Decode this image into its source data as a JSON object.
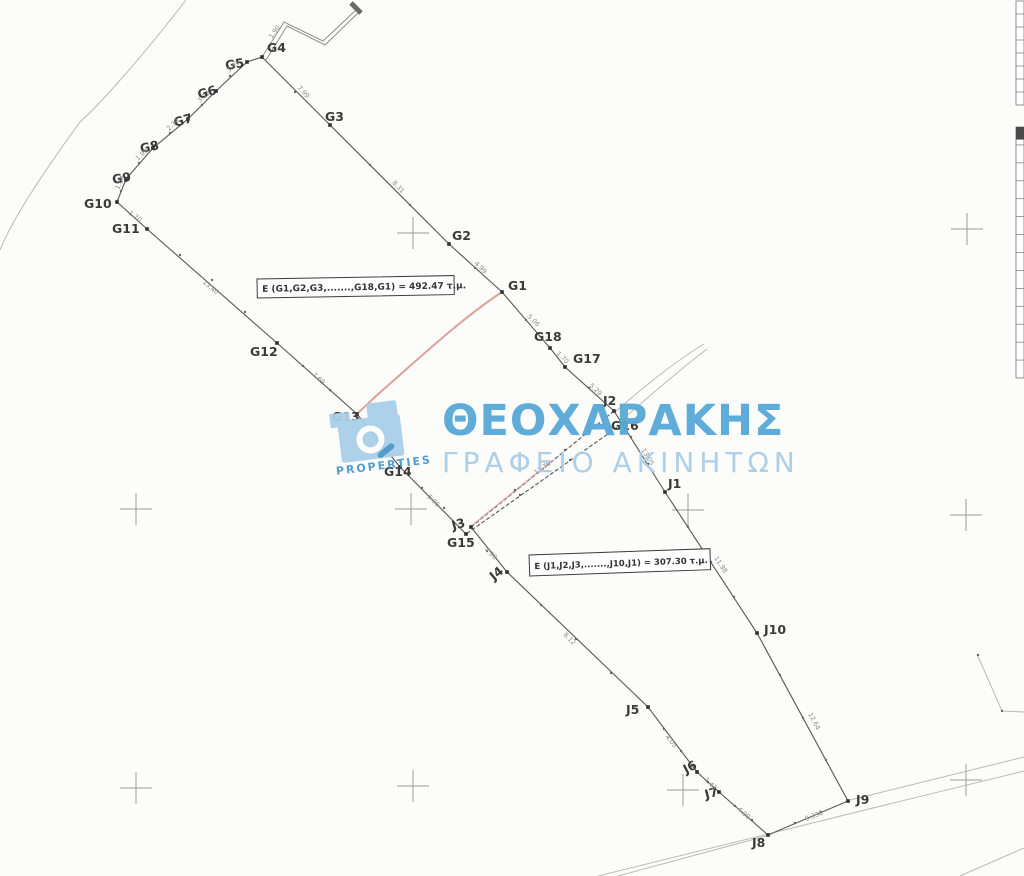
{
  "canvas": {
    "w": 1024,
    "h": 876
  },
  "watermark": {
    "brand": "ΘΕΟΧΑΡΑΚΗΣ",
    "subtitle": "ΓΡΑΦΕΙΟ ΑΚΙΝΗΤΩΝ",
    "logo_text": "PROPERTIES",
    "color_primary": "#58a8d8",
    "color_light": "#a9cde6"
  },
  "colors": {
    "boundary": "#5c5c5c",
    "road": "#b9b9b5",
    "cross": "#9c9c9c",
    "dim": "#8a8a8a",
    "label": "#3a3a3a",
    "red": "#d2837c",
    "red_light": "#dfa09a",
    "box_border": "#3c3c3c",
    "table": "#777777",
    "marker": "#2f2f2f",
    "dot": "#666666"
  },
  "area_labels": [
    {
      "id": "g-parcel",
      "text": "E (G1,G2,G3,.......,G18,G1) = 492.47 τ.μ.",
      "x": 257,
      "y": 279,
      "w": 197,
      "h": 19,
      "rot": -1,
      "font": 9
    },
    {
      "id": "j-parcel",
      "text": "E (J1,J2,J3,.......,J10,J1) = 307.30 τ.μ.",
      "x": 529,
      "y": 555,
      "w": 181,
      "h": 21,
      "rot": -2,
      "font": 8.5
    }
  ],
  "points": [
    {
      "name": "G1",
      "x": 502,
      "y": 292,
      "lx": 508,
      "ly": 290,
      "rot": 0
    },
    {
      "name": "G2",
      "x": 449,
      "y": 244,
      "lx": 452,
      "ly": 240,
      "rot": 0
    },
    {
      "name": "G3",
      "x": 330,
      "y": 125,
      "lx": 325,
      "ly": 121,
      "rot": 0
    },
    {
      "name": "G4",
      "x": 262,
      "y": 57,
      "lx": 267,
      "ly": 52,
      "rot": 0
    },
    {
      "name": "G5",
      "x": 247,
      "y": 62,
      "lx": 226,
      "ly": 70,
      "rot": -10
    },
    {
      "name": "G6",
      "x": 216,
      "y": 91,
      "lx": 199,
      "ly": 99,
      "rot": -16
    },
    {
      "name": "G7",
      "x": 188,
      "y": 119,
      "lx": 175,
      "ly": 127,
      "rot": -16
    },
    {
      "name": "G8",
      "x": 153,
      "y": 148,
      "lx": 141,
      "ly": 153,
      "rot": -12
    },
    {
      "name": "G9",
      "x": 126,
      "y": 179,
      "lx": 113,
      "ly": 184,
      "rot": -10
    },
    {
      "name": "G10",
      "x": 117,
      "y": 202,
      "lx": 84,
      "ly": 208,
      "rot": 0
    },
    {
      "name": "G11",
      "x": 147,
      "y": 229,
      "lx": 112,
      "ly": 233,
      "rot": 0
    },
    {
      "name": "G12",
      "x": 277,
      "y": 343,
      "lx": 250,
      "ly": 356,
      "rot": 0
    },
    {
      "name": "G13",
      "x": 357,
      "y": 414,
      "lx": 332,
      "ly": 421,
      "rot": 0
    },
    {
      "name": "G14",
      "x": 400,
      "y": 467,
      "lx": 384,
      "ly": 476,
      "rot": 0
    },
    {
      "name": "G15",
      "x": 466,
      "y": 534,
      "lx": 447,
      "ly": 547,
      "rot": 0
    },
    {
      "name": "G16",
      "x": 622,
      "y": 424,
      "lx": 611,
      "ly": 430,
      "rot": 0
    },
    {
      "name": "G17",
      "x": 565,
      "y": 367,
      "lx": 573,
      "ly": 363,
      "rot": 0
    },
    {
      "name": "G18",
      "x": 550,
      "y": 348,
      "lx": 534,
      "ly": 341,
      "rot": 0
    },
    {
      "name": "J1",
      "x": 665,
      "y": 492,
      "lx": 668,
      "ly": 488,
      "rot": 0
    },
    {
      "name": "J2",
      "x": 614,
      "y": 411,
      "lx": 603,
      "ly": 405,
      "rot": 0
    },
    {
      "name": "J3",
      "x": 471,
      "y": 527,
      "lx": 453,
      "ly": 530,
      "rot": -15
    },
    {
      "name": "J4",
      "x": 507,
      "y": 572,
      "lx": 494,
      "ly": 581,
      "rot": -40
    },
    {
      "name": "J5",
      "x": 648,
      "y": 707,
      "lx": 626,
      "ly": 714,
      "rot": 0
    },
    {
      "name": "J6",
      "x": 697,
      "y": 772,
      "lx": 686,
      "ly": 774,
      "rot": -28
    },
    {
      "name": "J7",
      "x": 719,
      "y": 792,
      "lx": 706,
      "ly": 799,
      "rot": -15
    },
    {
      "name": "J8",
      "x": 768,
      "y": 835,
      "lx": 752,
      "ly": 847,
      "rot": 0
    },
    {
      "name": "J9",
      "x": 848,
      "y": 801,
      "lx": 856,
      "ly": 804,
      "rot": 0
    },
    {
      "name": "J10",
      "x": 757,
      "y": 633,
      "lx": 764,
      "ly": 634,
      "rot": 0
    }
  ],
  "outlines": [
    {
      "id": "g-north-boundary",
      "pts": [
        "G4",
        "G3",
        "G2",
        "G1"
      ],
      "dash": ""
    },
    {
      "id": "g-west-boundary",
      "pts": [
        "G4",
        "G5",
        "G6",
        "G7",
        "G8",
        "G9",
        "G10",
        "G11"
      ],
      "dash": ""
    },
    {
      "id": "g-southwest-boundary",
      "pts": [
        "G11",
        "G12",
        "G13",
        "G14",
        "G15"
      ],
      "dash": ""
    },
    {
      "id": "ne-road-boundary",
      "pts": [
        "G1",
        "G18",
        "G17",
        "J2",
        "J1",
        "J10",
        "J9"
      ],
      "dash": ""
    },
    {
      "id": "divider-g15-g16",
      "pts": [
        "G16",
        "G15"
      ],
      "dash": "4 2"
    },
    {
      "id": "divider-j2-j3",
      "pts": [
        "J2",
        "J3"
      ],
      "dash": "4 2"
    },
    {
      "id": "j-southwest-boundary",
      "pts": [
        "J3",
        "J4",
        "J5",
        "J6",
        "J7",
        "J8"
      ],
      "dash": ""
    },
    {
      "id": "j-south-boundary",
      "pts": [
        "J8",
        "J9"
      ],
      "dash": ""
    }
  ],
  "dots": [
    [
      295,
      92
    ],
    [
      370,
      165
    ],
    [
      410,
      205
    ],
    [
      475,
      268
    ],
    [
      526,
      320
    ],
    [
      589,
      388
    ],
    [
      230,
      76
    ],
    [
      202,
      105
    ],
    [
      170,
      133
    ],
    [
      139,
      163
    ],
    [
      121,
      191
    ],
    [
      180,
      255
    ],
    [
      212,
      280
    ],
    [
      245,
      312
    ],
    [
      303,
      366
    ],
    [
      330,
      390
    ],
    [
      378,
      440
    ],
    [
      422,
      488
    ],
    [
      444,
      508
    ],
    [
      487,
      551
    ],
    [
      541,
      605
    ],
    [
      576,
      639
    ],
    [
      611,
      673
    ],
    [
      664,
      729
    ],
    [
      681,
      751
    ],
    [
      708,
      782
    ],
    [
      735,
      806
    ],
    [
      752,
      820
    ],
    [
      795,
      823
    ],
    [
      821,
      812
    ],
    [
      631,
      437
    ],
    [
      648,
      464
    ],
    [
      688,
      527
    ],
    [
      711,
      562
    ],
    [
      734,
      597
    ],
    [
      780,
      675
    ],
    [
      803,
      718
    ],
    [
      826,
      760
    ],
    [
      570,
      460
    ],
    [
      520,
      495
    ],
    [
      565,
      450
    ],
    [
      515,
      490
    ],
    [
      978,
      655
    ],
    [
      1002,
      711
    ]
  ],
  "red_paths": [
    {
      "id": "red-curve-g1-g13",
      "d": "M502,292 C462,318 415,362 376,396 C369,403 363,408 358,413",
      "w": 2,
      "color": "red",
      "op": 0.75
    },
    {
      "id": "red-divider-segment",
      "d": "M470,527 L553,460",
      "w": 1.4,
      "color": "red_light",
      "op": 0.8
    }
  ],
  "roads": [
    "M186,0 C140,60 96,108 80,122 C45,170 12,220 0,250",
    "M615,412 C648,383 676,361 704,344",
    "M622,420 C654,392 682,368 707,349",
    "M618,876 L766,836",
    "M850,800 L1024,757",
    "M598,876 C720,846 880,806 1024,771",
    "M960,876 L1024,848",
    "M977,654 L1002,711 L1024,712"
  ],
  "zigzag": {
    "outer": "M262,57 L284,22 L323,41 L356,10",
    "inner": "M266,60 L287,26 L325,45 L358,13",
    "cap": {
      "x1": 351,
      "y1": 3,
      "x2": 361,
      "y2": 13
    }
  },
  "crosses": [
    [
      413,
      233
    ],
    [
      967,
      229
    ],
    [
      136,
      509
    ],
    [
      411,
      509
    ],
    [
      688,
      510
    ],
    [
      966,
      515
    ],
    [
      136,
      788
    ],
    [
      413,
      786
    ],
    [
      683,
      790
    ],
    [
      966,
      780
    ]
  ],
  "cross_size": 16,
  "dims": [
    {
      "x": 297,
      "y": 88,
      "rot": 47,
      "t": "7.99"
    },
    {
      "x": 392,
      "y": 183,
      "rot": 47,
      "t": "8.31"
    },
    {
      "x": 474,
      "y": 264,
      "rot": 44,
      "t": "4.99"
    },
    {
      "x": 527,
      "y": 317,
      "rot": 44,
      "t": "5.06"
    },
    {
      "x": 556,
      "y": 354,
      "rot": 44,
      "t": "1.70"
    },
    {
      "x": 589,
      "y": 386,
      "rot": 44,
      "t": "5.29"
    },
    {
      "x": 229,
      "y": 73,
      "rot": -43,
      "t": "3.43"
    },
    {
      "x": 200,
      "y": 103,
      "rot": -43,
      "t": "3.17"
    },
    {
      "x": 169,
      "y": 131,
      "rot": -43,
      "t": "2.39"
    },
    {
      "x": 138,
      "y": 161,
      "rot": -43,
      "t": "1.99"
    },
    {
      "x": 119,
      "y": 190,
      "rot": -65,
      "t": "1.04"
    },
    {
      "x": 128,
      "y": 214,
      "rot": 35,
      "t": "1.70"
    },
    {
      "x": 202,
      "y": 283,
      "rot": 39,
      "t": "13.40"
    },
    {
      "x": 312,
      "y": 375,
      "rot": 43,
      "t": "7.69"
    },
    {
      "x": 427,
      "y": 497,
      "rot": 46,
      "t": "5.96"
    },
    {
      "x": 484,
      "y": 550,
      "rot": 43,
      "t": "4.90"
    },
    {
      "x": 563,
      "y": 635,
      "rot": 45,
      "t": "8.12"
    },
    {
      "x": 665,
      "y": 737,
      "rot": 51,
      "t": "4.05"
    },
    {
      "x": 704,
      "y": 780,
      "rot": 46,
      "t": "1.43"
    },
    {
      "x": 737,
      "y": 810,
      "rot": 41,
      "t": "4.90"
    },
    {
      "x": 806,
      "y": 821,
      "rot": -21,
      "t": "9.338"
    },
    {
      "x": 808,
      "y": 714,
      "rot": 62,
      "t": "12.64"
    },
    {
      "x": 714,
      "y": 558,
      "rot": 57,
      "t": "11.98"
    },
    {
      "x": 641,
      "y": 450,
      "rot": 58,
      "t": "13.05"
    },
    {
      "x": 536,
      "y": 475,
      "rot": -35,
      "t": "12.79"
    },
    {
      "x": 272,
      "y": 39,
      "rot": -55,
      "t": "1.90"
    }
  ],
  "tables": [
    {
      "x": 1016,
      "y": 1,
      "w": 8,
      "h": 104,
      "rows": 8,
      "header": false
    },
    {
      "x": 1016,
      "y": 127,
      "w": 8,
      "h": 251,
      "rows": 14,
      "header": true
    }
  ]
}
